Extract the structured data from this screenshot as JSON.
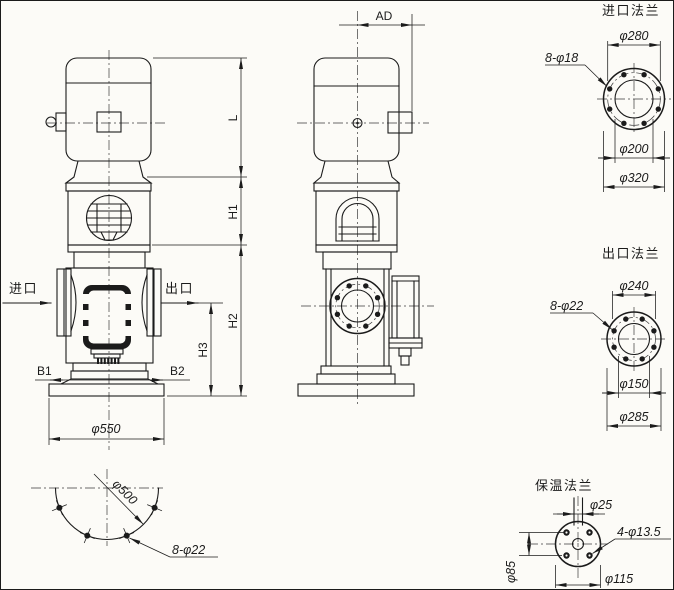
{
  "colors": {
    "ink": "#1b1b1b",
    "paper": "#fcfbf7"
  },
  "front_view": {
    "inlet_label": "进口",
    "outlet_label": "出口",
    "b1": "B1",
    "b2": "B2",
    "base_diameter": "φ550",
    "height_l": "L",
    "height_h1": "H1",
    "height_h2": "H2",
    "height_h3": "H3"
  },
  "side_view": {
    "offset_ad": "AD"
  },
  "foundation_detail": {
    "bolt_circle": "φ500",
    "bolt_holes": "8-φ22"
  },
  "inlet_flange_detail": {
    "title": "进口法兰",
    "bolt_circle": "φ280",
    "bolt_holes": "8-φ18",
    "bore": "φ200",
    "outer": "φ320"
  },
  "outlet_flange_detail": {
    "title": "出口法兰",
    "bolt_circle": "φ240",
    "bolt_holes": "8-φ22",
    "bore": "φ150",
    "outer": "φ285"
  },
  "insulation_flange_detail": {
    "title": "保温法兰",
    "pipe": "φ25",
    "bolt_holes": "4-φ13.5",
    "bolt_spacing": "φ85",
    "outer": "φ115"
  }
}
